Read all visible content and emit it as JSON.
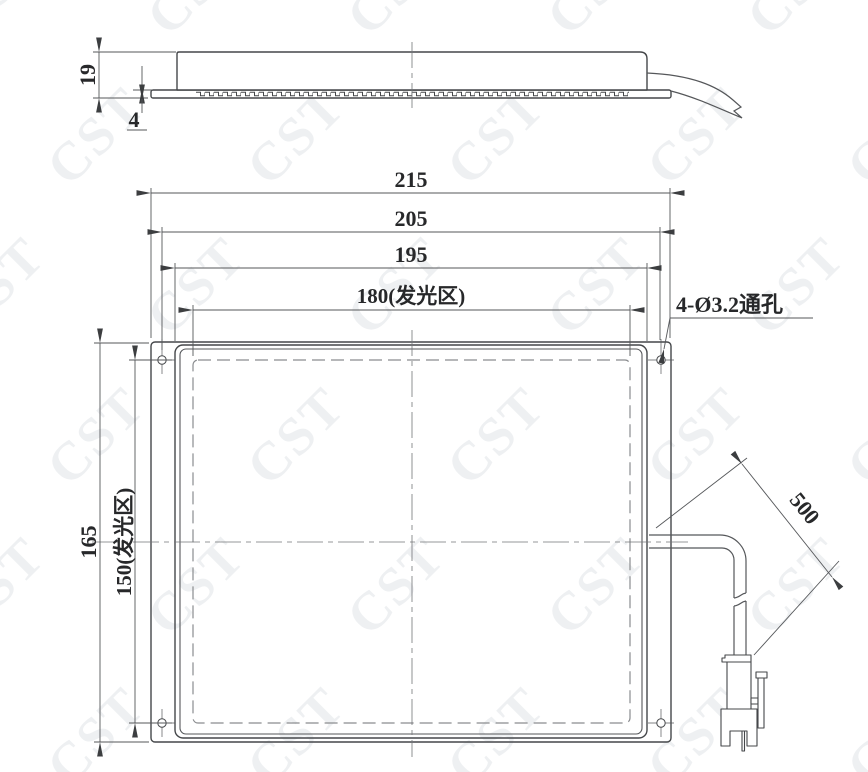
{
  "drawing": {
    "watermark": {
      "text": "CST",
      "color": "#eef0f2"
    },
    "side_view": {
      "height_dim": "19",
      "base_thickness_dim": "4"
    },
    "front_view": {
      "overall_width_dim": "215",
      "hole_spacing_dim": "205",
      "frame_width_dim": "195",
      "emitting_width_dim": "180(发光区)",
      "overall_height_dim": "165",
      "emitting_height_dim": "150(发光区)",
      "cable_length_dim": "500",
      "hole_callout": "4-Ø3.2通孔"
    }
  }
}
